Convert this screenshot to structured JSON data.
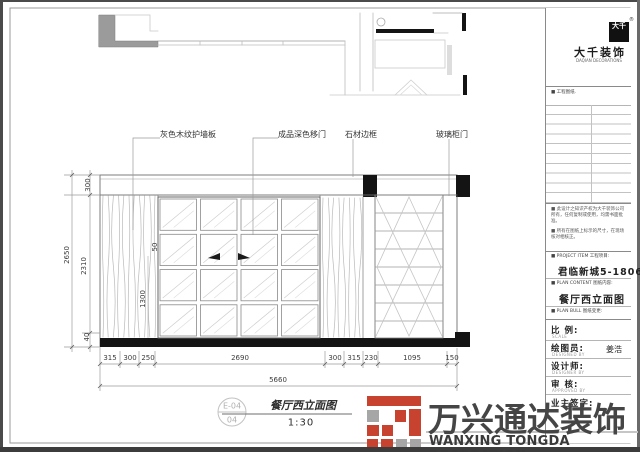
{
  "callouts": {
    "wall_panel": "灰色木纹护墙板",
    "sliding_door": "成品深色移门",
    "stone_frame": "石材边框",
    "glass_cabinet_door": "玻璃柜门"
  },
  "dimensions": {
    "left": {
      "band": "300",
      "overall": "2650",
      "inner": "2310",
      "base": "40"
    },
    "internal": {
      "gap": "50",
      "height": "1300"
    },
    "bottom": [
      "315",
      "300",
      "250",
      "2690",
      "300",
      "315",
      "230",
      "1095",
      "150"
    ],
    "total": "5660"
  },
  "title_bubble": {
    "code": "E-04",
    "sheet": "04"
  },
  "drawing_title": {
    "name": "餐厅西立面图",
    "scale": "1:30"
  },
  "title_block": {
    "logo": {
      "seal": "大千",
      "registered": "®",
      "brand": "大千装饰",
      "brand_sub": "DAQIAN DECORATIONS"
    },
    "sheet_label": "■ 工程图纸.",
    "notes": [
      "■ 此设计之知识产权为大千装饰公司所有，任何复制或使用，均需书面批准。",
      "■ 所有在图纸上标示的尺寸，在现场核对相核正。"
    ],
    "project": {
      "label": "■ PROJECT ITEM  工程项目:",
      "value": "君临新城5-1806"
    },
    "content": {
      "label": "■ PLAN CONTENT  图纸内容:",
      "value": "餐厅西立面图"
    },
    "bull": {
      "label": "■ PLAN BULL  图纸变更:"
    },
    "fields": [
      {
        "label": "比 例:",
        "sub": "SCALE",
        "value": ""
      },
      {
        "label": "绘图员:",
        "sub": "DESIGNED BY",
        "value": "姜浩"
      },
      {
        "label": "设计师:",
        "sub": "DESIGNER BY",
        "value": ""
      },
      {
        "label": "审 核:",
        "sub": "APPROVED BY",
        "value": ""
      },
      {
        "label": "业主签字:",
        "sub": "",
        "value": ""
      }
    ]
  },
  "watermark": {
    "cn": "万兴通达装饰",
    "en": "WANXING TONGDA DECORATION",
    "accent_red": "#c8432f",
    "accent_gray": "#a6a6a6"
  }
}
